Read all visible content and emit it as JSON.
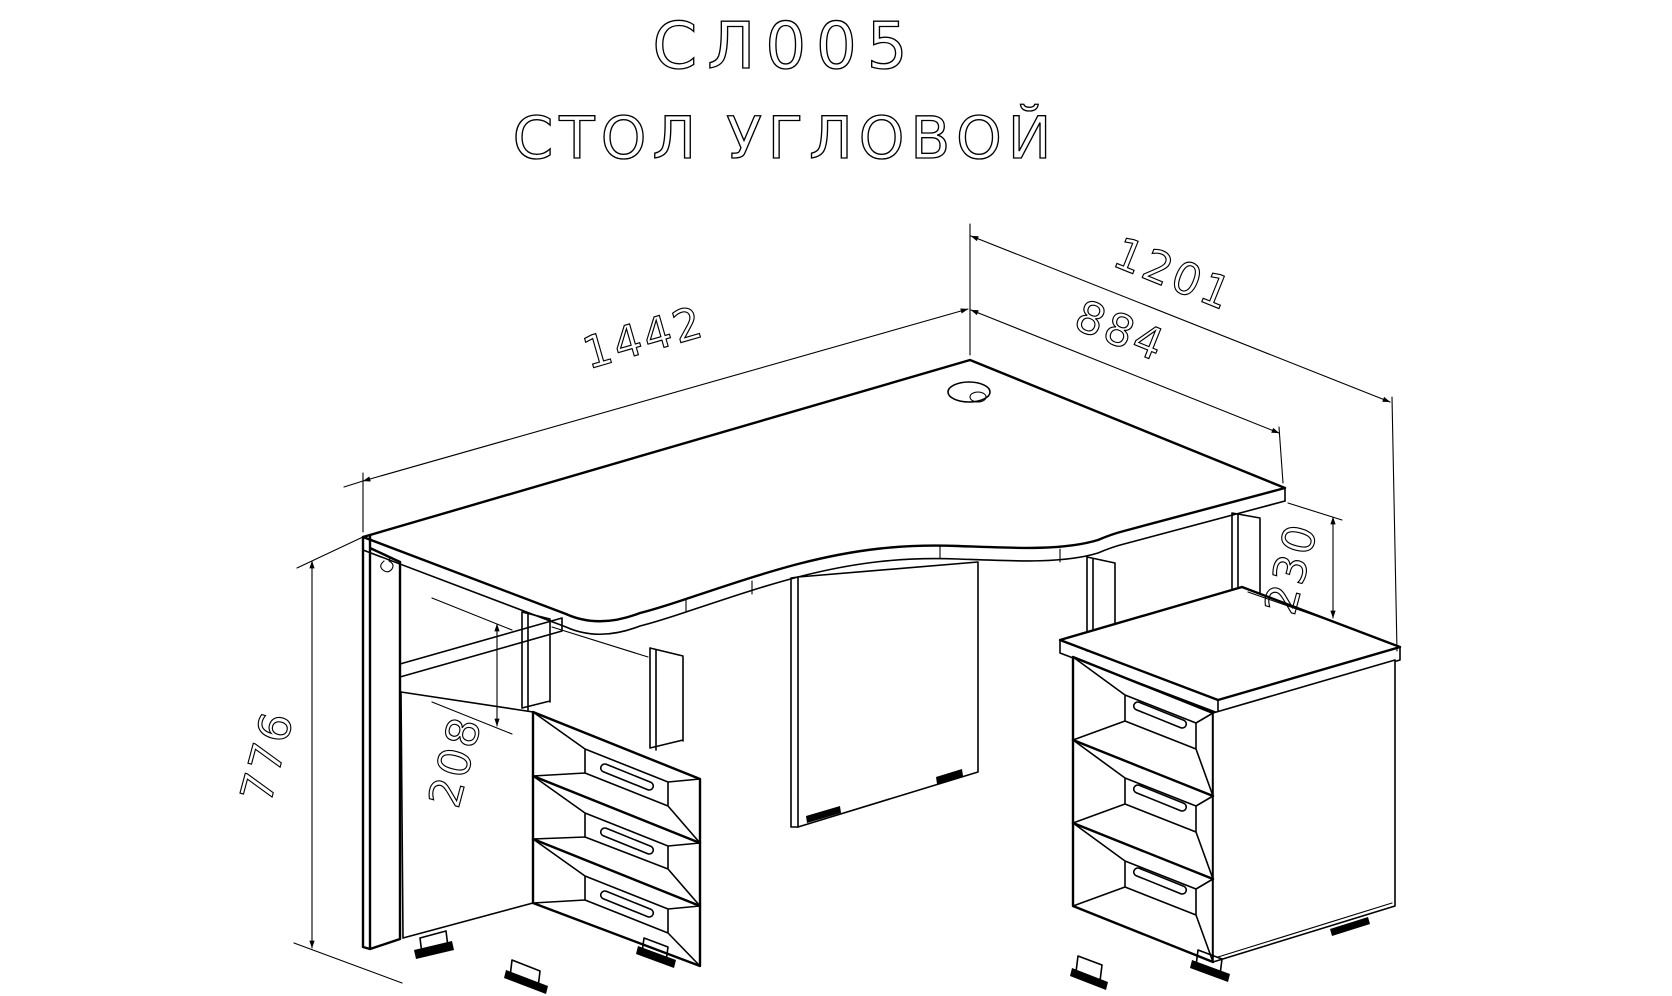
{
  "title": {
    "model_code": "СЛ005",
    "product_name": "СТОЛ УГЛОВОЙ"
  },
  "dimensions": {
    "desk_width": "1442",
    "right_back_edge": "884",
    "right_depth_total": "1201",
    "desk_height": "776",
    "niche_height": "208",
    "top_to_pedestal_gap": "230"
  },
  "drawing": {
    "type": "isometric furniture assembly drawing",
    "line_color": "#000000",
    "background_color": "#ffffff",
    "parts": [
      "desktop with corner curve and cable grommet",
      "left pedestal with open niche and 3 drawers",
      "right pedestal with 3 drawers",
      "modesty panel",
      "support columns",
      "adjustable feet"
    ]
  }
}
